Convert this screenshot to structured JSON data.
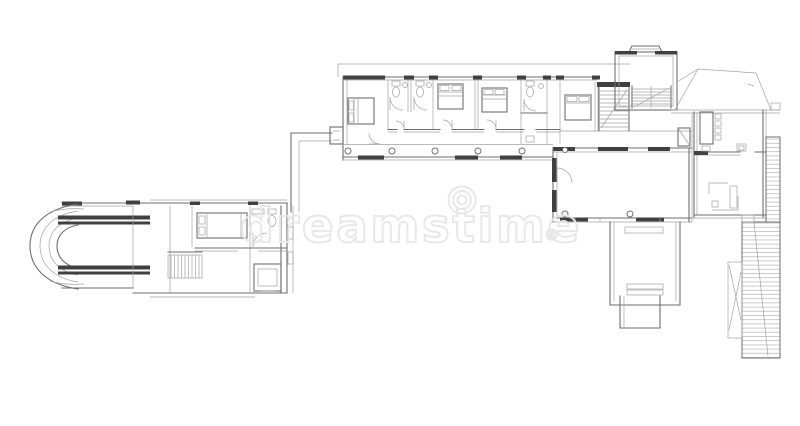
{
  "meta": {
    "description": "Black-and-white architect blueprint: plan view of a long modern house with a curved-end left wing, connecting walkway, bedroom wing with bathrooms, stair tower, hip roof, dining and kitchen block, living room, patio steps and hatched deck strips."
  },
  "watermark": {
    "brand": "dreamstime",
    "registered_mark": "®"
  },
  "palette": {
    "background": "#ffffff",
    "wall-dark": "#404040",
    "line-medium": "#6e6e6e",
    "line-light": "#a3a3a3",
    "hatch": "#b4b4b4",
    "watermark": "#e7e7e7"
  },
  "plan": {
    "areas": [
      "left-wing",
      "curved-wall-end",
      "left-wing-stairs",
      "walkway",
      "bedroom-wing",
      "bedrooms",
      "bathrooms",
      "corridor-columns",
      "stair-tower",
      "hip-roof",
      "dining-room",
      "kitchen",
      "living-room",
      "patio-steps",
      "deck-hatched"
    ]
  }
}
